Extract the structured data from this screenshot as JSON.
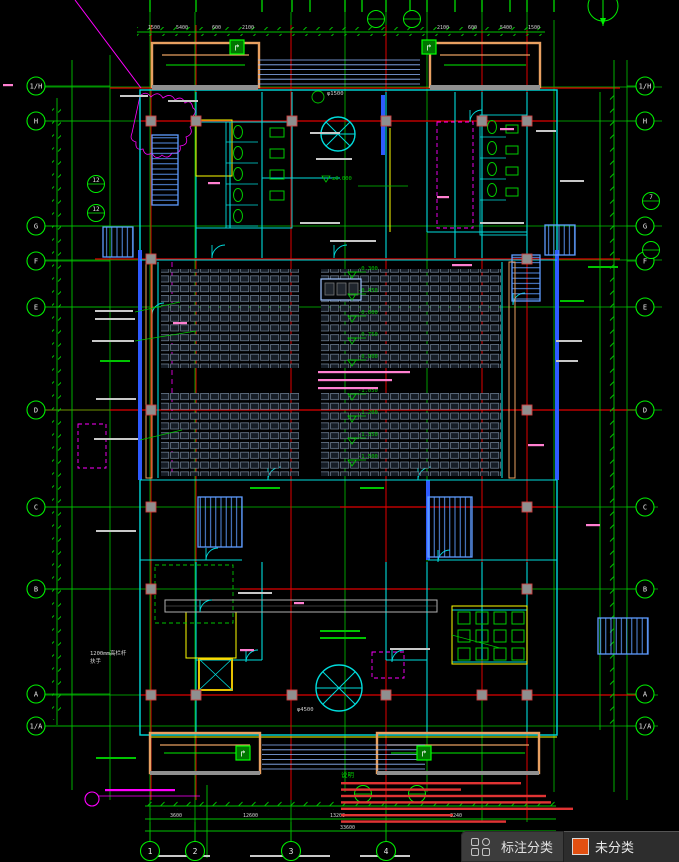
{
  "toolbar": {
    "categories_label": "标注分类",
    "unclassified_label": "未分类",
    "swatch_color": "#e25012"
  },
  "drawing": {
    "colors": {
      "line_green": "#00c400",
      "bright_green": "#00ee00",
      "axis_red": "#e00000",
      "wall_cyan": "#00dcdc",
      "wall_blue": "#2e5bff",
      "stair_blue": "#5e9cff",
      "ramp_orange": "#e8a061",
      "magenta": "#ff00ff",
      "pink": "#ff7fd0",
      "note_red": "#e03434",
      "fixture_green": "#00cc00",
      "column_gray": "#8f8f8f",
      "dim_white": "#d0d0d0"
    },
    "grid": {
      "rows": [
        "1/H",
        "H",
        "G",
        "F",
        "E",
        "D",
        "C",
        "B",
        "A",
        "1/A"
      ],
      "cols": [
        "1",
        "2",
        "3",
        "4"
      ]
    },
    "levels": {
      "datum": "±0.000",
      "aisle": [
        "-0.300",
        "-0.450",
        "-0.600",
        "-0.750",
        "-0.900",
        "-1.050",
        "-1.200",
        "-1.350",
        "-1.500"
      ]
    },
    "labels": {
      "notes_header": "说明",
      "guardrail_line1": "1200mm高栏杆",
      "guardrail_line2": "扶手",
      "dia_small": "φ1500",
      "dia_large": "φ4500"
    },
    "dims": {
      "top_left": [
        "1500",
        "5400",
        "600",
        "2100"
      ],
      "top_right": [
        "2100",
        "600",
        "5400",
        "1500"
      ],
      "bottom": [
        "3600",
        "12600",
        "13200",
        "3240"
      ],
      "bottom_total": "33600"
    },
    "detail_tags": [
      "12",
      "12",
      "7"
    ]
  }
}
